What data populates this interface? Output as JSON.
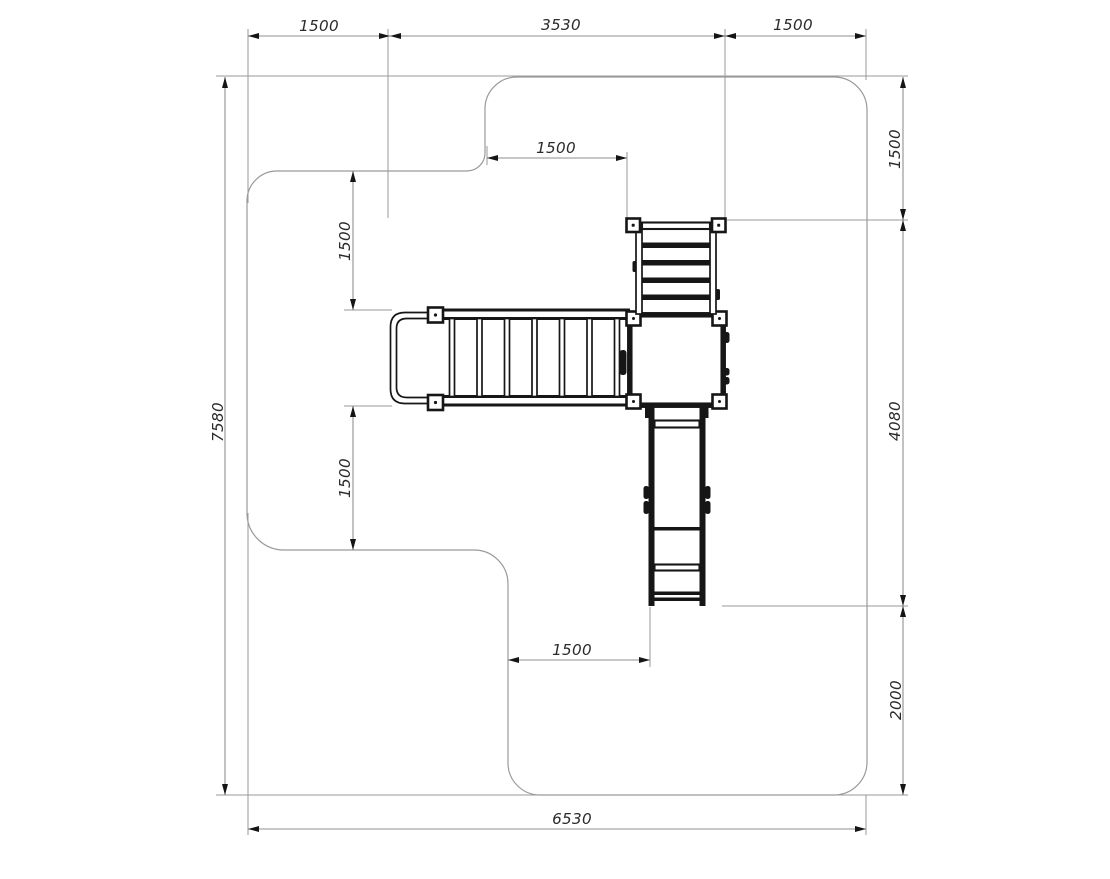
{
  "drawing": {
    "kind": "playground equipment plan view with safety-zone outline",
    "colors": {
      "background": "#ffffff",
      "outline_line": "#9a9a9a",
      "dimension_line": "#8f8f8f",
      "arrow": "#151515",
      "structure": "#161616",
      "label_text": "#2b2b2b"
    },
    "dimensions": {
      "top": {
        "left": "1500",
        "middle": "3530",
        "right": "1500"
      },
      "right": {
        "top": "1500",
        "middle": "4080",
        "bottom": "2000"
      },
      "left": {
        "overall_height": "7580"
      },
      "bottom": {
        "overall_width": "6530"
      },
      "inner": {
        "ladder_offset_top": "1500",
        "bridge_offset_upper": "1500",
        "bridge_offset_lower": "1500",
        "slide_offset_bottom": "1500"
      }
    }
  }
}
